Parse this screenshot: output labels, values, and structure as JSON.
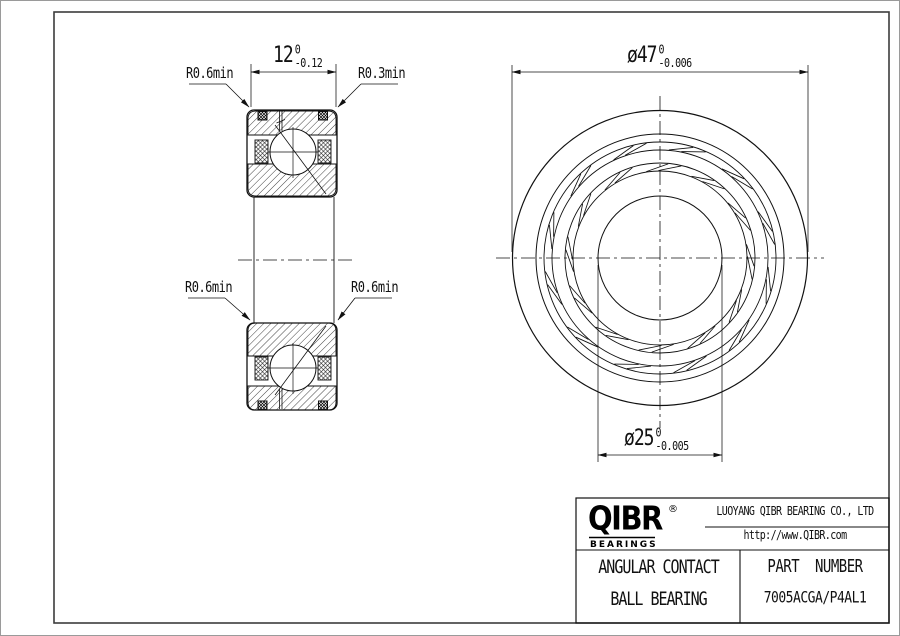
{
  "dimensions": {
    "width": {
      "value": "12",
      "upper": "0",
      "lower": "-0.12"
    },
    "outer_diameter": {
      "value": "ø47",
      "upper": "0",
      "lower": "-0.006"
    },
    "bore_diameter": {
      "value": "ø25",
      "upper": "0",
      "lower": "-0.005"
    }
  },
  "radius_labels": {
    "top_left": "R0.6min",
    "top_right": "R0.3min",
    "bottom_left": "R0.6min",
    "bottom_right": "R0.6min"
  },
  "title_block": {
    "logo_name": "QIBR",
    "logo_reg": "®",
    "logo_sub": "BEARINGS",
    "company": "LUOYANG QIBR BEARING CO., LTD",
    "website": "http://www.QIBR.com",
    "product_line1": "ANGULAR CONTACT",
    "product_line2": "BALL BEARING",
    "part_label": "PART  NUMBER",
    "part_number": "7005ACGA/P4AL1"
  },
  "colors": {
    "line": "#111111",
    "frame": "#3c3c3c",
    "background": "#ffffff"
  }
}
